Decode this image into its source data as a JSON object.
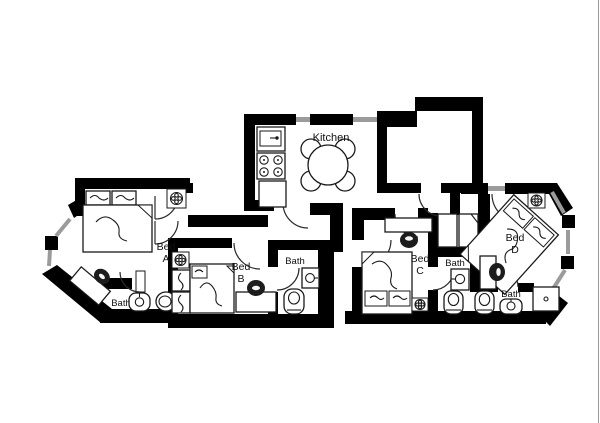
{
  "canvas": {
    "width": 600,
    "height": 423,
    "background": "#ffffff",
    "edge_line_color": "#9a9a9a"
  },
  "palette": {
    "wall": "#000000",
    "window": "#9b9b9b",
    "furniture_line": "#1a1a1a",
    "text": "#111111"
  },
  "rooms": {
    "kitchen": {
      "name": "Kitchen"
    },
    "bed_a": {
      "line1": "Bed",
      "line2": "A"
    },
    "bed_b": {
      "line1": "Bed",
      "line2": "B"
    },
    "bed_c": {
      "line1": "Bed",
      "line2": "C"
    },
    "bed_d": {
      "line1": "Bed",
      "line2": "D"
    },
    "bath_a": {
      "name": "Bath"
    },
    "bath_b": {
      "name": "Bath"
    },
    "bath_c": {
      "name": "Bath"
    },
    "bath_d": {
      "name": "Bath"
    }
  }
}
